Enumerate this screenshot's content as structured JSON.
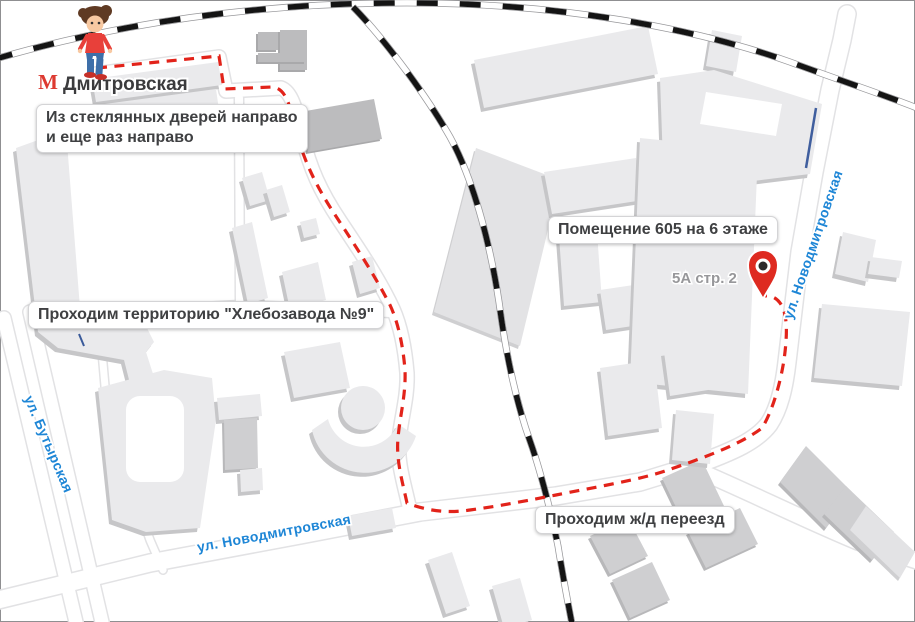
{
  "map": {
    "metro": {
      "station_name": "Дмитровская",
      "icon_letter": "М"
    },
    "callouts": {
      "exit": {
        "line1": "Из стеклянных дверей направо",
        "line2": "и еще раз направо"
      },
      "territory": {
        "text": "Проходим территорию \"Хлебозавода №9\""
      },
      "destination": {
        "text": "Помещение 605 на 6 этаже"
      },
      "crossing": {
        "text": "Проходим ж/д переезд"
      }
    },
    "streets": {
      "butyrskaya": "ул. Бутырская",
      "novodmitrovskaya_bottom": "ул. Новодмитровская",
      "novodmitrovskaya_right": "ул. Новодмитровская"
    },
    "building_label": "5А стр. 2",
    "colors": {
      "route": "#e2231a",
      "street_label": "#1e86d6",
      "railway": "#141414",
      "pin": "#de2a20",
      "building_fill": "#eaeaec",
      "building_side": "#c6c6c8",
      "callout_text": "#3f4042",
      "metro_red": "#dd3a31"
    }
  }
}
